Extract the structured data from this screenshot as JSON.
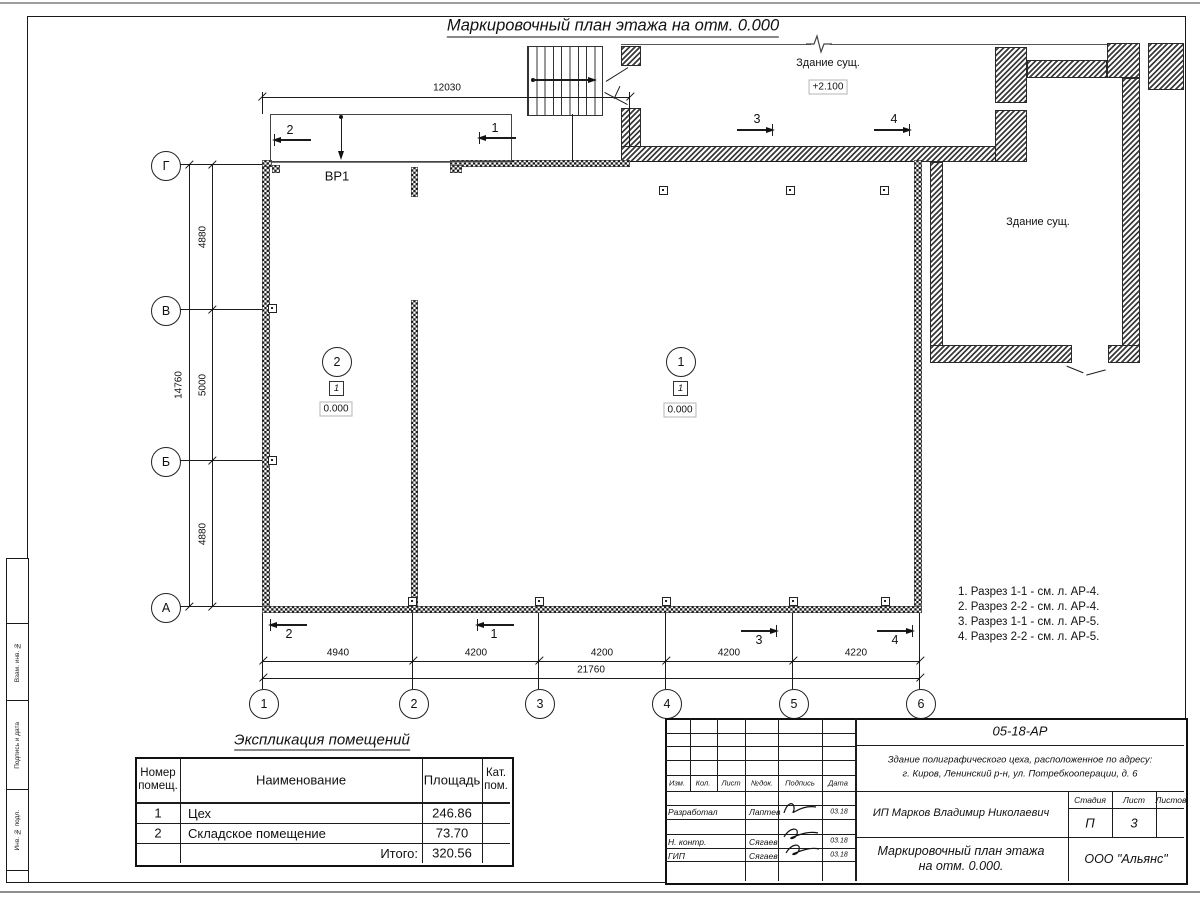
{
  "sheet": {
    "title": "Маркировочный план этажа на отм. 0.000"
  },
  "plan": {
    "gate_label": "ВР1",
    "existing_top_label": "Здание сущ.",
    "existing_top_elevation": "+2.100",
    "existing_right_label": "Здание сущ.",
    "rooms": [
      {
        "number": "2",
        "type": "1",
        "elevation": "0.000"
      },
      {
        "number": "1",
        "type": "1",
        "elevation": "0.000"
      }
    ],
    "axes_left": [
      "Г",
      "В",
      "Б",
      "А"
    ],
    "axes_bottom": [
      "1",
      "2",
      "3",
      "4",
      "5",
      "6"
    ],
    "dim_top": "12030",
    "dims_left": [
      "4880",
      "5000",
      "4880"
    ],
    "dim_left_total": "14760",
    "dims_bottom": [
      "4940",
      "4200",
      "4200",
      "4200",
      "4220"
    ],
    "dim_bottom_total": "21760",
    "sections_top": [
      "2",
      "1",
      "3",
      "4"
    ],
    "sections_bottom": [
      "2",
      "1",
      "3",
      "4"
    ]
  },
  "notes": [
    "1. Разрез 1-1 - см. л. АР-4.",
    "2. Разрез 2-2 - см. л. АР-4.",
    "3. Разрез 1-1 - см. л. АР-5.",
    "4. Разрез 2-2 - см. л. АР-5."
  ],
  "explication": {
    "title": "Экспликация помещений",
    "col_number": "Номер помещ.",
    "col_name": "Наименование",
    "col_area": "Площадь",
    "col_cat": "Кат. пом.",
    "rows": [
      {
        "number": "1",
        "name": "Цех",
        "area": "246.86"
      },
      {
        "number": "2",
        "name": "Складское помещение",
        "area": "73.70"
      }
    ],
    "total_label": "Итого:",
    "total_value": "320.56"
  },
  "title_block": {
    "doc_code": "05-18-АР",
    "address1": "Здание полиграфического цеха, расположенное по адресу:",
    "address2": "г. Киров,  Ленинский р-н, ул. Потребкооперации, д. 6",
    "client": "ИП Марков Владимир Николаевич",
    "title1": "Маркировочный план этажа",
    "title2": "на отм. 0.000.",
    "company": "ООО \"Альянс\"",
    "stage_label": "Стадия",
    "sheet_label": "Лист",
    "sheets_label": "Листов",
    "stage": "П",
    "sheet": "3",
    "cols": [
      "Изм.",
      "Кол.",
      "Лист",
      "№док.",
      "Подпись",
      "Дата"
    ],
    "row_dev_role": "Разработал",
    "row_dev_name": "Лаптев",
    "row_dev_date": "03.18",
    "row_nc_role": "Н. контр.",
    "row_nc_name": "Сягаев",
    "row_nc_date": "03.18",
    "row_gip_role": "ГИП",
    "row_gip_name": "Сягаев",
    "row_gip_date": "03.18"
  },
  "margin_stamps": [
    "Взам. инв. №",
    "Подпись и дата",
    "Инв. № подл."
  ]
}
